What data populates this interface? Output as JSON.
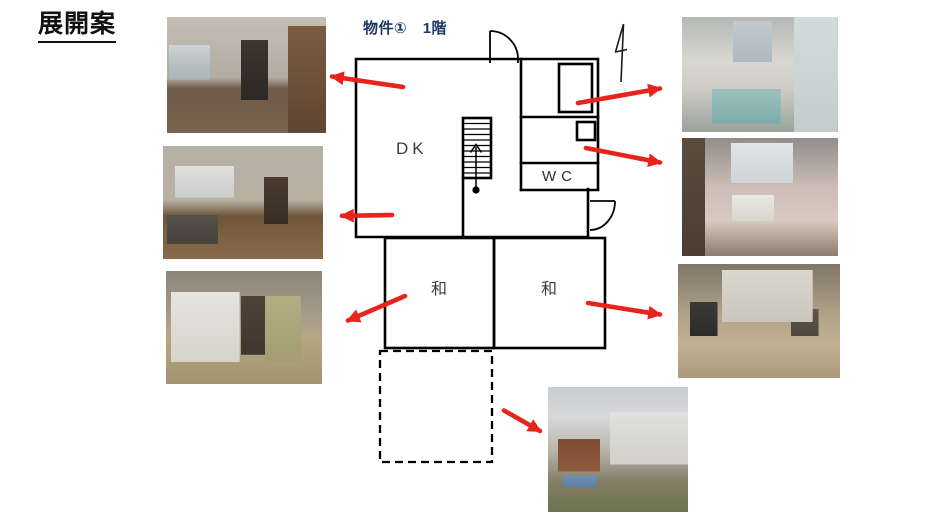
{
  "page": {
    "title": "展開案"
  },
  "plan": {
    "label": "物件①　1階",
    "rooms": [
      {
        "name": "dining-kitchen",
        "label": "DK"
      },
      {
        "name": "toilet",
        "label": "WC"
      },
      {
        "name": "japanese-room-left",
        "label": "和"
      },
      {
        "name": "japanese-room-right",
        "label": "和"
      }
    ],
    "features": [
      "stairs-up",
      "entry-door",
      "genkan-door",
      "north-arrow",
      "dashed-extension-area",
      "bathtub",
      "wash-corner"
    ]
  },
  "photos": [
    {
      "name": "kitchen-photo",
      "desc": "old kitchen with stainless sink counter, window and hallway"
    },
    {
      "name": "living-room-photo",
      "desc": "living room with window, floral sofa, low table and cabinets"
    },
    {
      "name": "tatami-room-left-photo",
      "desc": "tatami room with lace curtains, pendant lamp and green curtain"
    },
    {
      "name": "bathroom-photo",
      "desc": "bathroom with blue-green bathtub, tiled walls and window"
    },
    {
      "name": "washroom-photo",
      "desc": "washroom with utility sink, pink tile and bright window"
    },
    {
      "name": "tatami-room-right-photo",
      "desc": "tatami room with old TV, armchair and lace curtains"
    },
    {
      "name": "exterior-photo",
      "desc": "house exterior with carport and overgrown garden"
    }
  ],
  "arrows": [
    {
      "name": "arrow-dk-to-kitchen",
      "direction": "left"
    },
    {
      "name": "arrow-dk-to-living",
      "direction": "left"
    },
    {
      "name": "arrow-wa-left-to-tatami",
      "direction": "down-left"
    },
    {
      "name": "arrow-bath-to-photo",
      "direction": "right"
    },
    {
      "name": "arrow-washroom-to-photo",
      "direction": "right"
    },
    {
      "name": "arrow-wa-right-to-tatami",
      "direction": "right"
    },
    {
      "name": "arrow-dashed-to-exterior",
      "direction": "down-right"
    }
  ],
  "colors": {
    "arrow_red": "#e8231c",
    "label_navy": "#1f3864",
    "wall_black": "#000000"
  }
}
